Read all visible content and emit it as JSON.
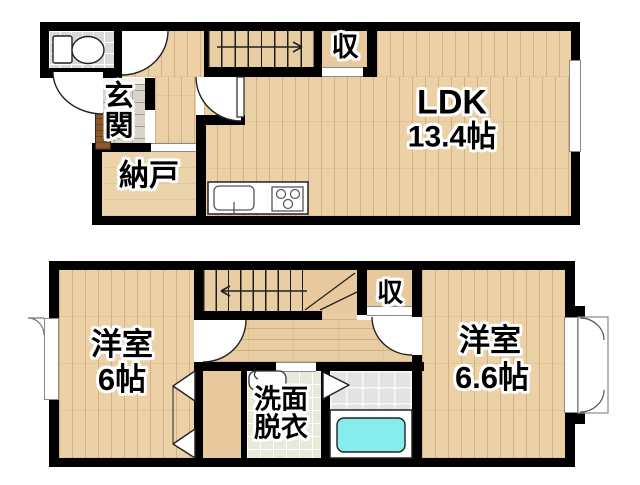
{
  "page": {
    "type": "japanese-floor-plan",
    "floors": 2,
    "background": "#ffffff"
  },
  "colors": {
    "wall": "#000000",
    "wood_floor": "#ecd0a6",
    "stair_floor": "#e9cda2",
    "toilet_tile": "#d9d9d9",
    "entrance_stone": "#d8d4c9",
    "washroom_tile": "#e8e9db",
    "bath_tile": "#e3e3e3",
    "bathtub": "#86ecec",
    "entry_door": "#8a5a2b"
  },
  "floor1": {
    "ldk": {
      "label": "LDK",
      "size": "13.4帖"
    },
    "closet": {
      "label": "収"
    },
    "entrance": {
      "label": "玄関"
    },
    "storage": {
      "label": "納戸"
    }
  },
  "floor2": {
    "bedroom_left": {
      "label": "洋室",
      "size": "6帖"
    },
    "washroom": {
      "label": "洗面脱衣"
    },
    "closet": {
      "label": "収"
    },
    "bedroom_right": {
      "label": "洋室",
      "size": "6.6帖"
    }
  }
}
